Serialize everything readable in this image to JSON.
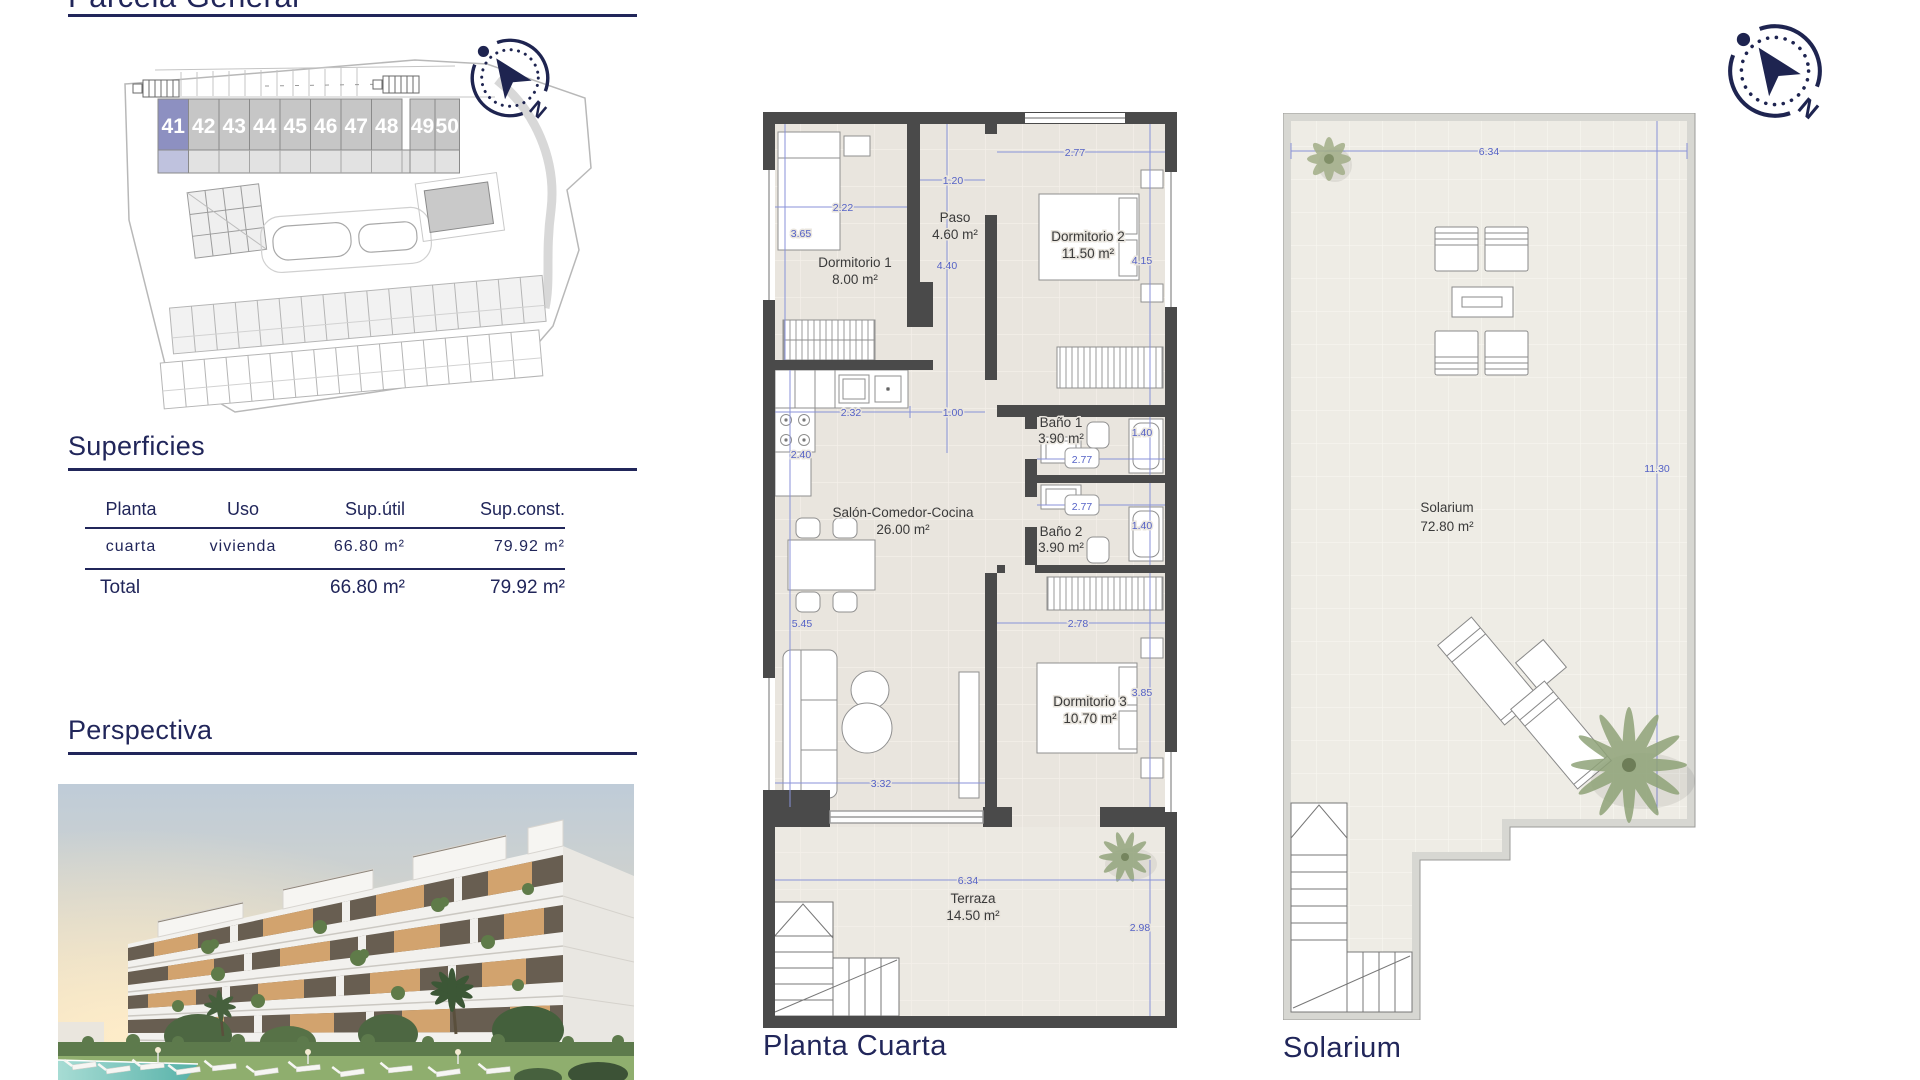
{
  "page": {
    "title": "Parcela General",
    "colors": {
      "accent_navy": "#21265a",
      "dimension_blue": "#5562c6",
      "wall_gray": "#4a4a4a",
      "floor_beige": "#e9e5de",
      "unit_gray": "#c6c6c6",
      "unit_highlight": "#8d90c1"
    }
  },
  "site_plan": {
    "units": [
      "41",
      "42",
      "43",
      "44",
      "45",
      "46",
      "47",
      "48",
      "49",
      "50"
    ],
    "highlighted_unit": "41"
  },
  "superficies": {
    "heading": "Superficies",
    "columns": [
      "Planta",
      "Uso",
      "Sup.útil",
      "Sup.const."
    ],
    "row": {
      "planta": "cuarta",
      "uso": "vivienda",
      "sup_util": "66.80 m²",
      "sup_const": "79.92 m²"
    },
    "total": {
      "label": "Total",
      "sup_util": "66.80 m²",
      "sup_const": "79.92 m²"
    }
  },
  "perspectiva": {
    "heading": "Perspectiva"
  },
  "floor_plan": {
    "label": "Planta Cuarta",
    "rooms": [
      {
        "name": "Dormitorio 1",
        "area": "8.00 m²"
      },
      {
        "name": "Paso",
        "area": "4.60 m²"
      },
      {
        "name": "Dormitorio 2",
        "area": "11.50 m²"
      },
      {
        "name": "Baño 1",
        "area": "3.90 m²"
      },
      {
        "name": "Baño 2",
        "area": "3.90 m²"
      },
      {
        "name": "Salón-Comedor-Cocina",
        "area": "26.00 m²"
      },
      {
        "name": "Dormitorio 3",
        "area": "10.70 m²"
      },
      {
        "name": "Terraza",
        "area": "14.50 m²"
      }
    ],
    "dims": [
      "2.22",
      "3.65",
      "1.20",
      "4.40",
      "2.77",
      "4.15",
      "2.32",
      "1.00",
      "2.40",
      "1.40",
      "2.77",
      "2.77",
      "1.40",
      "5.45",
      "2.78",
      "3.85",
      "3.32",
      "6.34",
      "2.98"
    ]
  },
  "solarium": {
    "label": "Solarium",
    "name": "Solarium",
    "area": "72.80 m²",
    "dim_width": "6.34",
    "dim_height": "11.30"
  },
  "compass": {
    "north_label": "N"
  }
}
